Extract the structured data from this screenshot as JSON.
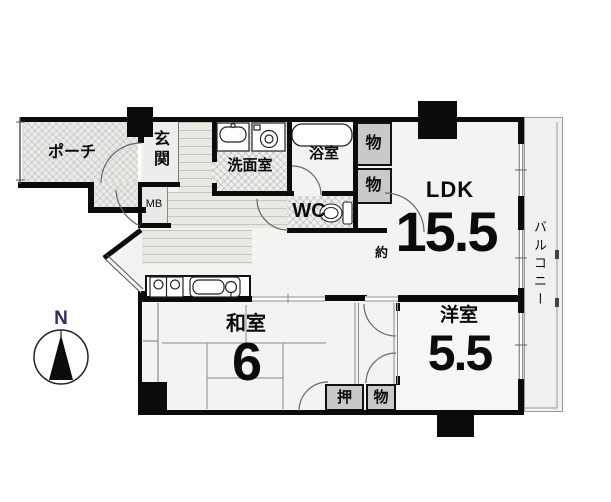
{
  "plan": {
    "type": "japanese-apartment-floorplan",
    "porch": {
      "label": "ポーチ"
    },
    "entrance": {
      "label": "玄関"
    },
    "meter_box": {
      "label": "MB"
    },
    "washroom": {
      "label": "洗面室"
    },
    "bathroom": {
      "label": "浴室"
    },
    "toilet": {
      "label": "WC"
    },
    "storage_top_upper": {
      "label": "物"
    },
    "storage_top_lower": {
      "label": "物"
    },
    "ldk": {
      "label": "LDK",
      "approx_prefix": "約",
      "size_jo": "15.5"
    },
    "japanese_room": {
      "label": "和室",
      "size_jo": "6"
    },
    "western_room": {
      "label": "洋室",
      "size_jo": "5.5"
    },
    "closet_oshiire": {
      "label": "押"
    },
    "closet_mono": {
      "label": "物"
    },
    "balcony": {
      "label": "バルコニー"
    },
    "compass": {
      "north_label": "N"
    }
  },
  "colors": {
    "wall": "#0b0b0b",
    "floor": "#f3f3f1",
    "closet_fill": "#c9c9c9",
    "hatch_fill": "#e9e9e6",
    "balcony_fill": "#f0f0ee",
    "north_letter": "#2a2f6b"
  }
}
